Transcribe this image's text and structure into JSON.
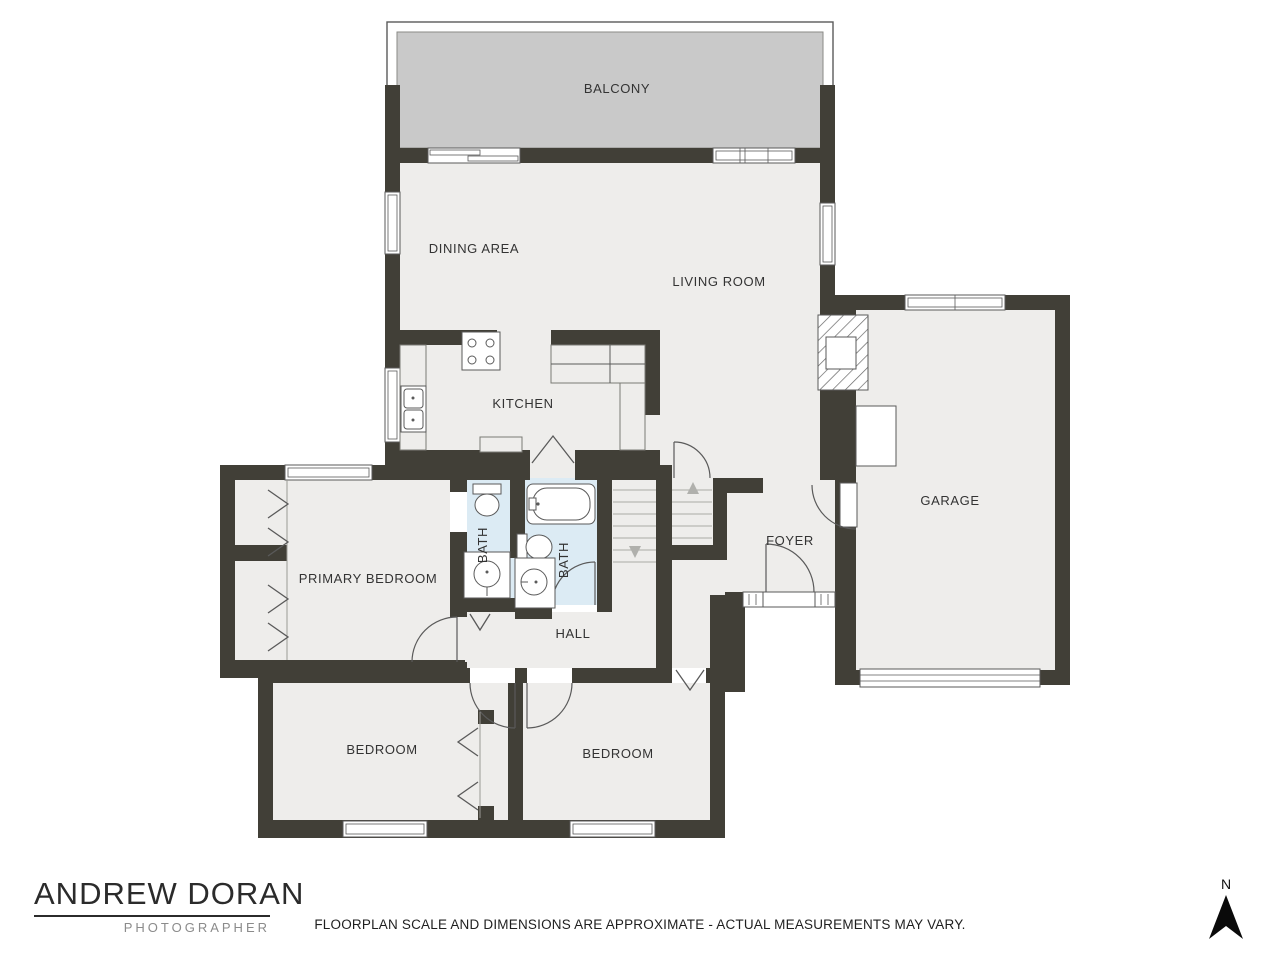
{
  "rooms": {
    "balcony": "BALCONY",
    "dining": "DINING AREA",
    "living": "LIVING ROOM",
    "kitchen": "KITCHEN",
    "garage": "GARAGE",
    "foyer": "FOYER",
    "primary_bedroom": "PRIMARY BEDROOM",
    "hall": "HALL",
    "bath_left": "BATH",
    "bath_right": "BATH",
    "bedroom_left": "BEDROOM",
    "bedroom_right": "BEDROOM"
  },
  "branding": {
    "name": "ANDREW DORAN",
    "tagline": "PHOTOGRAPHER"
  },
  "disclaimer": "FLOORPLAN SCALE AND DIMENSIONS ARE APPROXIMATE - ACTUAL MEASUREMENTS MAY VARY.",
  "compass": {
    "label": "N"
  },
  "colors": {
    "wall": "#413f37",
    "floor": "#eeedeb",
    "balcony_deck": "#c9c9c9",
    "bath_floor": "#dcebf4",
    "outline": "#5a5a5a"
  }
}
